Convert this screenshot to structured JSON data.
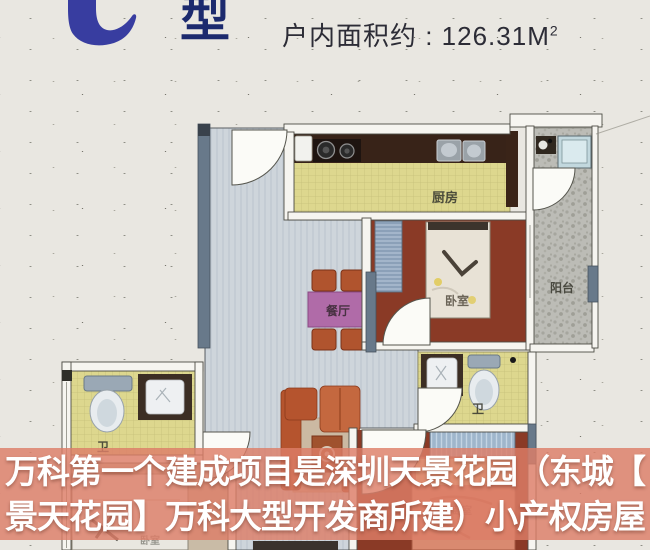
{
  "header": {
    "unit_type_suffix": "型",
    "area_label": "户内面积约 : 126.31M",
    "area_superscript": "2"
  },
  "floorplan": {
    "rooms": {
      "kitchen": "厨房",
      "dining": "餐厅",
      "bedroom_main": "卧室",
      "balcony": "阳台",
      "bath_left": "卫",
      "bath_right": "卫",
      "bedroom_bottom_left": "卧室",
      "bedroom_bottom_right": "卧室"
    }
  },
  "overlay": {
    "line1": "万科第一个建成项目是深圳天景花园（东城【",
    "line2": "景天花园】万科大型开发商所建）小产权房屋",
    "band_color": "rgba(221,126,104,0.82)",
    "text_color": "#ffffff"
  },
  "colors": {
    "title_blue": "#383da0",
    "title_navy": "#1c2a6e",
    "paper": "#e9e7e1",
    "wall_slate": "#68798a",
    "kitchen_tile": "#ddd78e",
    "bedroom_floor": "#8a3a26",
    "hall_floor": "#ced5db",
    "balcony_floor": "#bcbcb6",
    "counter_brown": "#382318",
    "sofa_terracotta": "#b5542e",
    "dining_table_purple": "#b06ba8"
  }
}
